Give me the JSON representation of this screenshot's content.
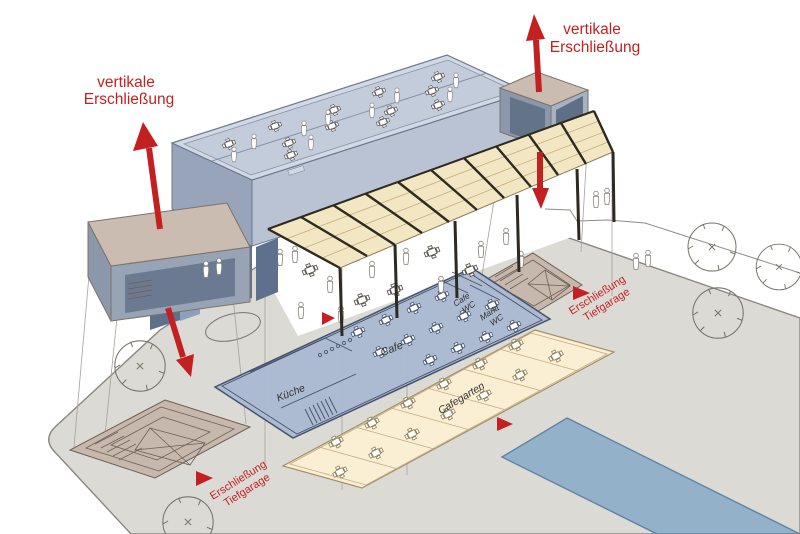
{
  "annotations": {
    "vertical_left": {
      "line1": "vertikale",
      "line2": "Erschließung"
    },
    "vertical_right": {
      "line1": "vertikale",
      "line2": "Erschließung"
    },
    "garage_left": {
      "line1": "Erschließung",
      "line2": "Tiefgarage"
    },
    "garage_right": {
      "line1": "Erschließung",
      "line2": "Tiefgarage"
    }
  },
  "plan_labels": {
    "cafe": "Cafe",
    "kitchen": "Küche",
    "garden": "Cafegarten",
    "cafe_wc_line1": "Cafe",
    "cafe_wc_line2": "WC",
    "markt_wc_line1": "Markt",
    "markt_wc_line2": "WC"
  },
  "colors": {
    "red": "#c32121",
    "ground": "#dcdad4",
    "plan_blue": "#aab9d2",
    "plan_cream": "#faeed3",
    "canopy_cream": "#f3e6c3",
    "beam_dark": "#2e2a20",
    "tower_tan": "#cbbcb1",
    "building_wall": "#b9c3d4",
    "roof_parapet": "#d2d9e4",
    "roof_deck": "#c3ccda",
    "window_dark": "#5d708c",
    "pool_blue": "#93b1c9"
  }
}
